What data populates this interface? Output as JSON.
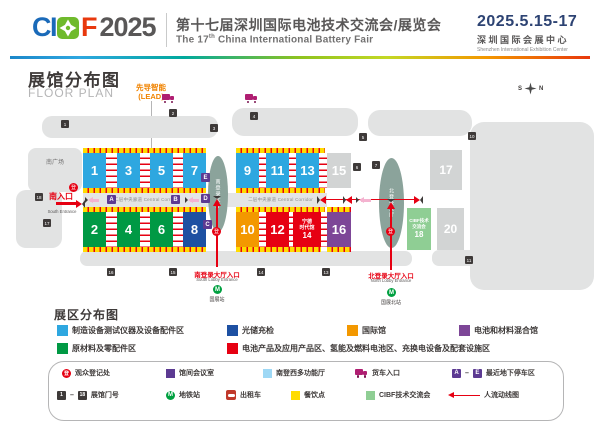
{
  "header": {
    "logo_ci": "CI",
    "logo_f": "F",
    "logo_year": "2025",
    "title_cn": "第十七届深圳国际电池技术交流会/展览会",
    "title_en_a": "The 17",
    "title_en_sup": "th",
    "title_en_b": " China International Battery Fair",
    "date": "2025.5.15-17",
    "venue_cn": "深圳国际会展中心",
    "venue_en": "Shenzhen International Exhibition Center"
  },
  "icons": {
    "register": "登",
    "star": "★"
  },
  "map": {
    "title_cn": "展馆分布图",
    "title_en": "FLOOR PLAN",
    "lead_cn": "先导智能",
    "lead_en": "(LEAD)",
    "compass_s": "S",
    "compass_n": "N",
    "south_plaza": "南广场",
    "corridor": "二层中央廊道 Central Corridor",
    "south_entrance_cn": "南入口",
    "south_entrance_en": "South Entrance",
    "south_lobby": "南登录大厅",
    "north_lobby": "北登录大厅",
    "south_lobby_entrance_cn": "南登录大厅入口",
    "south_lobby_entrance_en": "South Lobby Entrance",
    "north_lobby_entrance_cn": "北登录大厅入口",
    "north_lobby_entrance_en": "North Lobby Entrance",
    "metro_south": "国展站",
    "metro_north": "国展北站",
    "halls": {
      "h1": "1",
      "h2": "2",
      "h3": "3",
      "h4": "4",
      "h5": "5",
      "h6": "6",
      "h7": "7",
      "h8": "8",
      "h9": "9",
      "h10": "10",
      "h11": "11",
      "h12": "12",
      "h13": "13",
      "h15": "15",
      "h16": "16",
      "h17": "17",
      "h20": "20"
    },
    "hall14": {
      "l1": "宁德",
      "l2": "时代馆",
      "n": "14"
    },
    "cibf18": {
      "l1": "CIBF技术",
      "l2": "交流会",
      "n": "18"
    },
    "conn": {
      "a": "A",
      "b": "B",
      "c": "C",
      "d": "D",
      "e": "E"
    },
    "gates": {
      "g1": "1",
      "g2": "2",
      "g3": "3",
      "g4": "4",
      "g5": "5",
      "g6": "6",
      "g7": "7",
      "g10": "10",
      "g11": "11",
      "g13": "13",
      "g14": "14",
      "g15": "15",
      "g16": "16",
      "g17": "17",
      "g18": "18"
    }
  },
  "zones": {
    "title": "展区分布图",
    "items": [
      {
        "label": "制造设备测试仪器及设备配件区",
        "color": "#2EA7E0"
      },
      {
        "label": "光储充检",
        "color": "#1D50A2"
      },
      {
        "label": "国际馆",
        "color": "#F39800"
      },
      {
        "label": "电池和材料混合馆",
        "color": "#7D4697"
      },
      {
        "label": "原材料及零配件区",
        "color": "#009944"
      },
      {
        "label": "电池产品及应用产品区、氢能及燃料电池区、充换电设备及配套设施区",
        "color": "#E60012"
      }
    ]
  },
  "legend": {
    "dash": "–",
    "register": "观众登记处",
    "meeting_room": "馆间会议室",
    "multi_hall": "南登西多功能厅",
    "truck_entrance": "货车入口",
    "parking_a": "A",
    "parking_e": "E",
    "parking": "最近地下停车区",
    "gate_1": "1",
    "gate_18": "18",
    "gate_no": "展馆门号",
    "metro": "地铁站",
    "taxi": "出租车",
    "dining": "餐饮点",
    "cibf": "CIBF技术交流会",
    "flow": "人流动线图"
  }
}
